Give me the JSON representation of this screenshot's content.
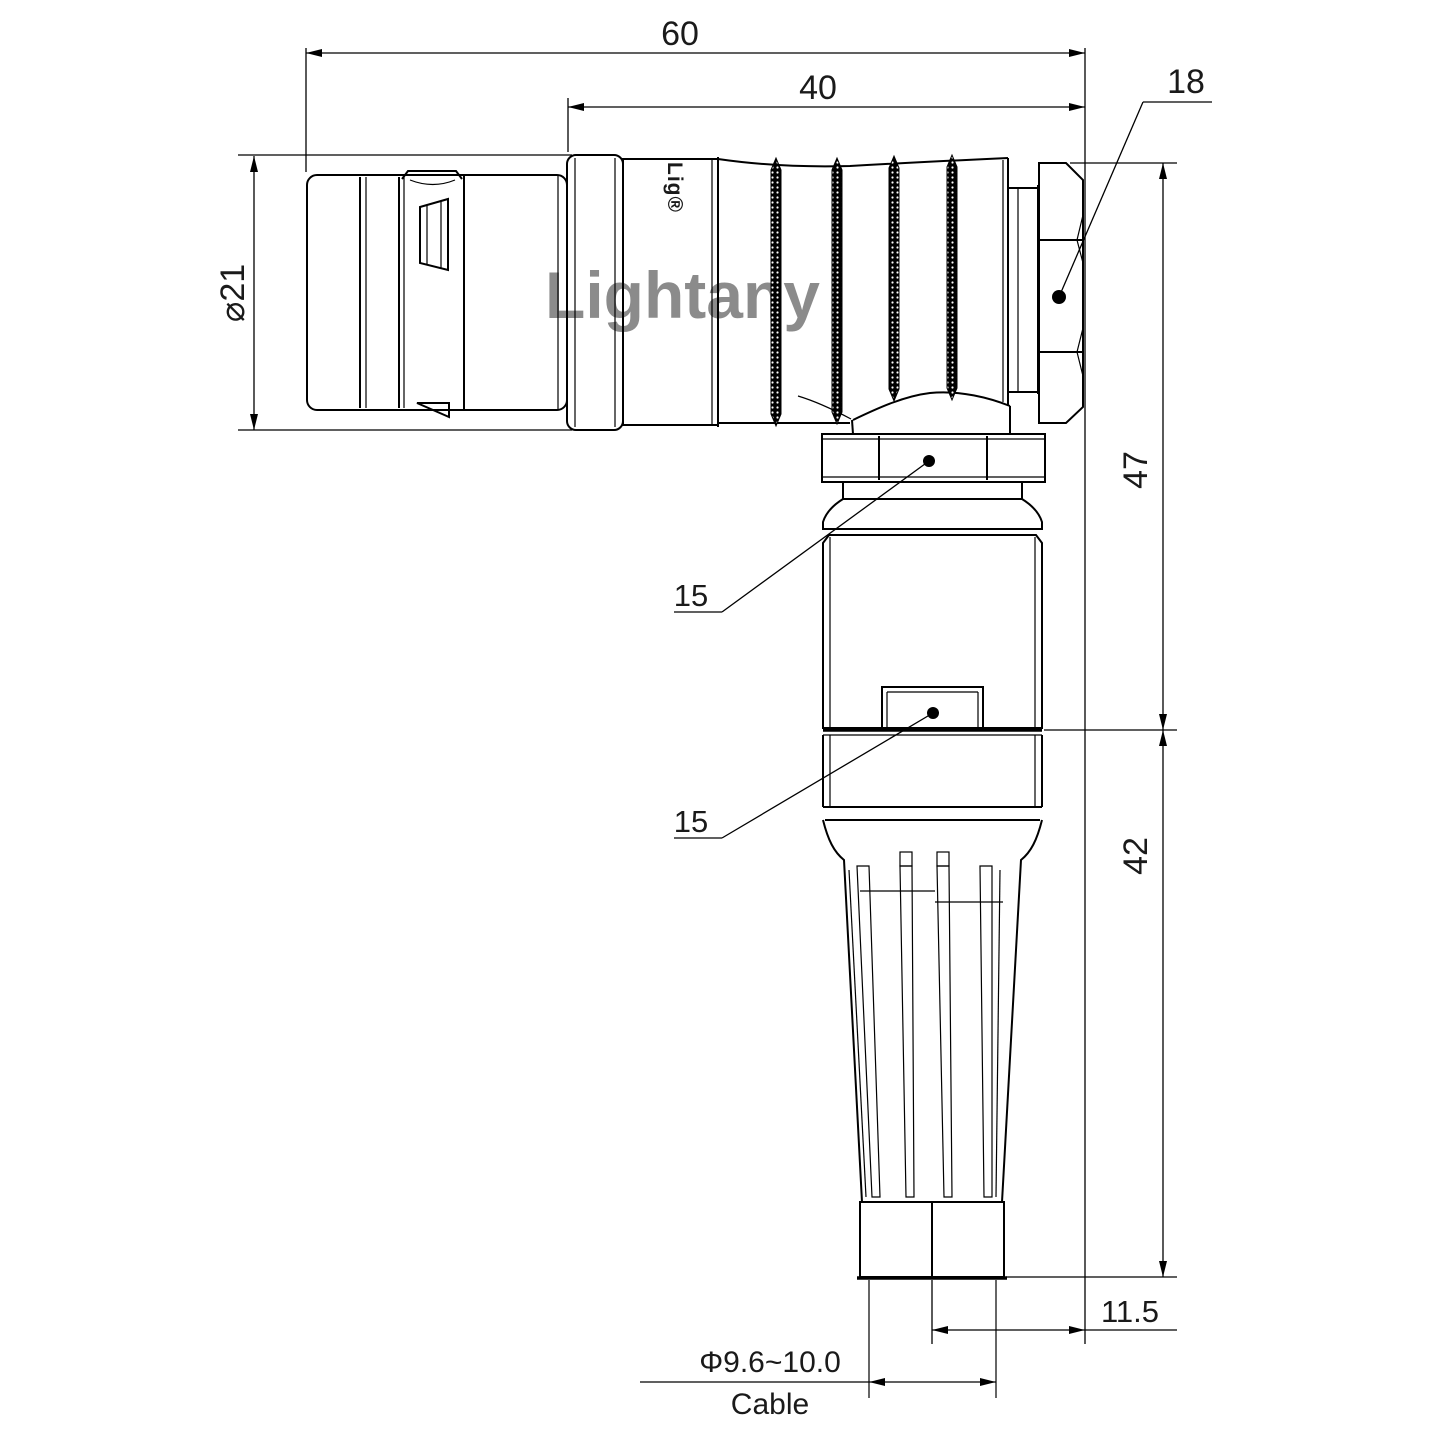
{
  "drawing": {
    "title": "Right-angle push-pull connector with cable strain relief — dimensioned outline drawing",
    "watermark": "Lightany",
    "brand_logo": "Lig®",
    "annotations": {
      "overall_length": "60",
      "rear_body_length": "40",
      "hex_nut_size": "18",
      "shell_diameter": "⌀21",
      "upper_height": "47",
      "lower_height": "42",
      "right_offset": "11.5",
      "cable_diameter": "Φ9.6~10.0",
      "cable_label": "Cable",
      "coupling_nut_note": "15",
      "housing_nut_note": "15"
    },
    "colors": {
      "line": "#000000",
      "text": "#1a1a1a",
      "watermark": "#f2c9c9",
      "background": "#ffffff"
    }
  }
}
